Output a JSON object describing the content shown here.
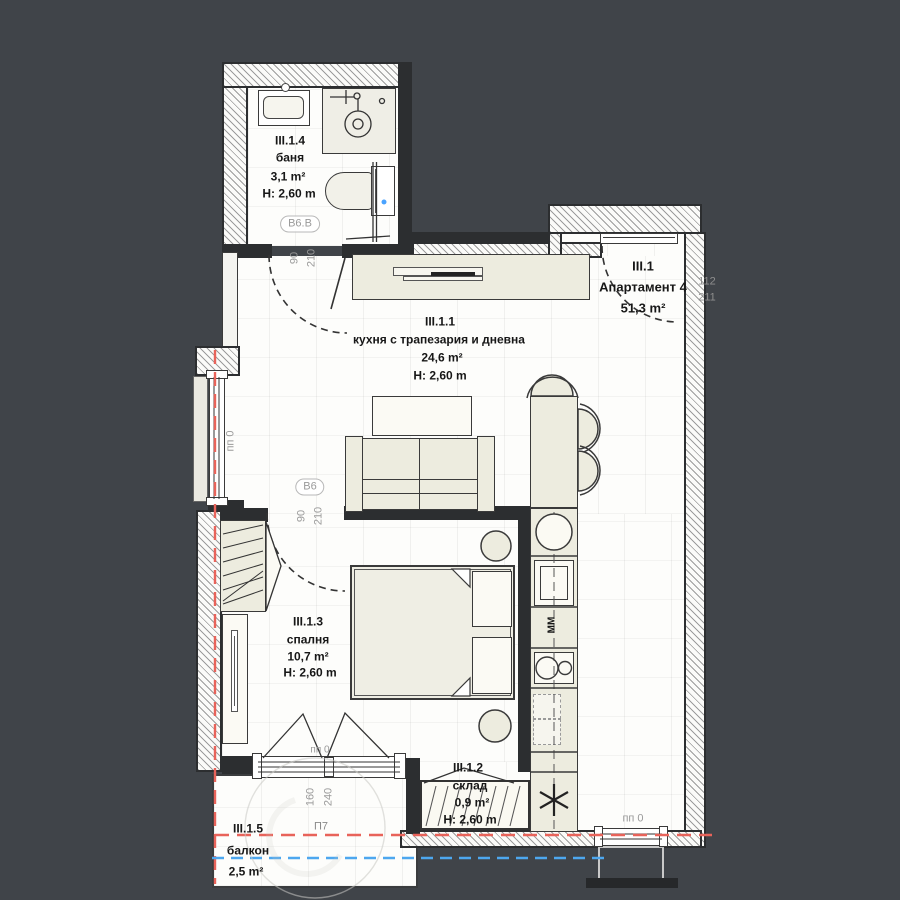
{
  "apartment": {
    "id": "III.1",
    "name": "Апартамент 4",
    "area": "51,3 m²"
  },
  "rooms": {
    "bathroom": {
      "id": "III.1.4",
      "name": "баня",
      "area": "3,1 m²",
      "height": "H: 2,60 m"
    },
    "living": {
      "id": "III.1.1",
      "name": "кухня с трапезария и дневна",
      "area": "24,6 m²",
      "height": "H: 2,60 m"
    },
    "bedroom": {
      "id": "III.1.3",
      "name": "спалня",
      "area": "10,7 m²",
      "height": "H: 2,60 m"
    },
    "storage": {
      "id": "III.1.2",
      "name": "склад",
      "area": "0,9 m²",
      "height": "H: 2,60 m"
    },
    "balcony": {
      "id": "III.1.5",
      "name": "балкон",
      "area": "2,5 m²"
    }
  },
  "doors": {
    "bathroom": {
      "tag": "B6.B",
      "width": "90",
      "height": "210"
    },
    "bedroom": {
      "tag": "B6",
      "width": "90",
      "height": "210"
    },
    "entrance": {
      "width": "112",
      "height": "211"
    },
    "balcony_door": {
      "tag": "П7",
      "width": "160",
      "height": "240"
    }
  },
  "windows": {
    "left_label": "пп 0",
    "balcony_label": "пп 0",
    "bottom_label": "пп 0"
  },
  "kitchen": {
    "microwave_label": "ММ"
  },
  "colors": {
    "background": "#404449",
    "section_line_red": "#e8635a",
    "section_line_blue": "#4da7ef",
    "furniture_fill": "#edecdf"
  }
}
